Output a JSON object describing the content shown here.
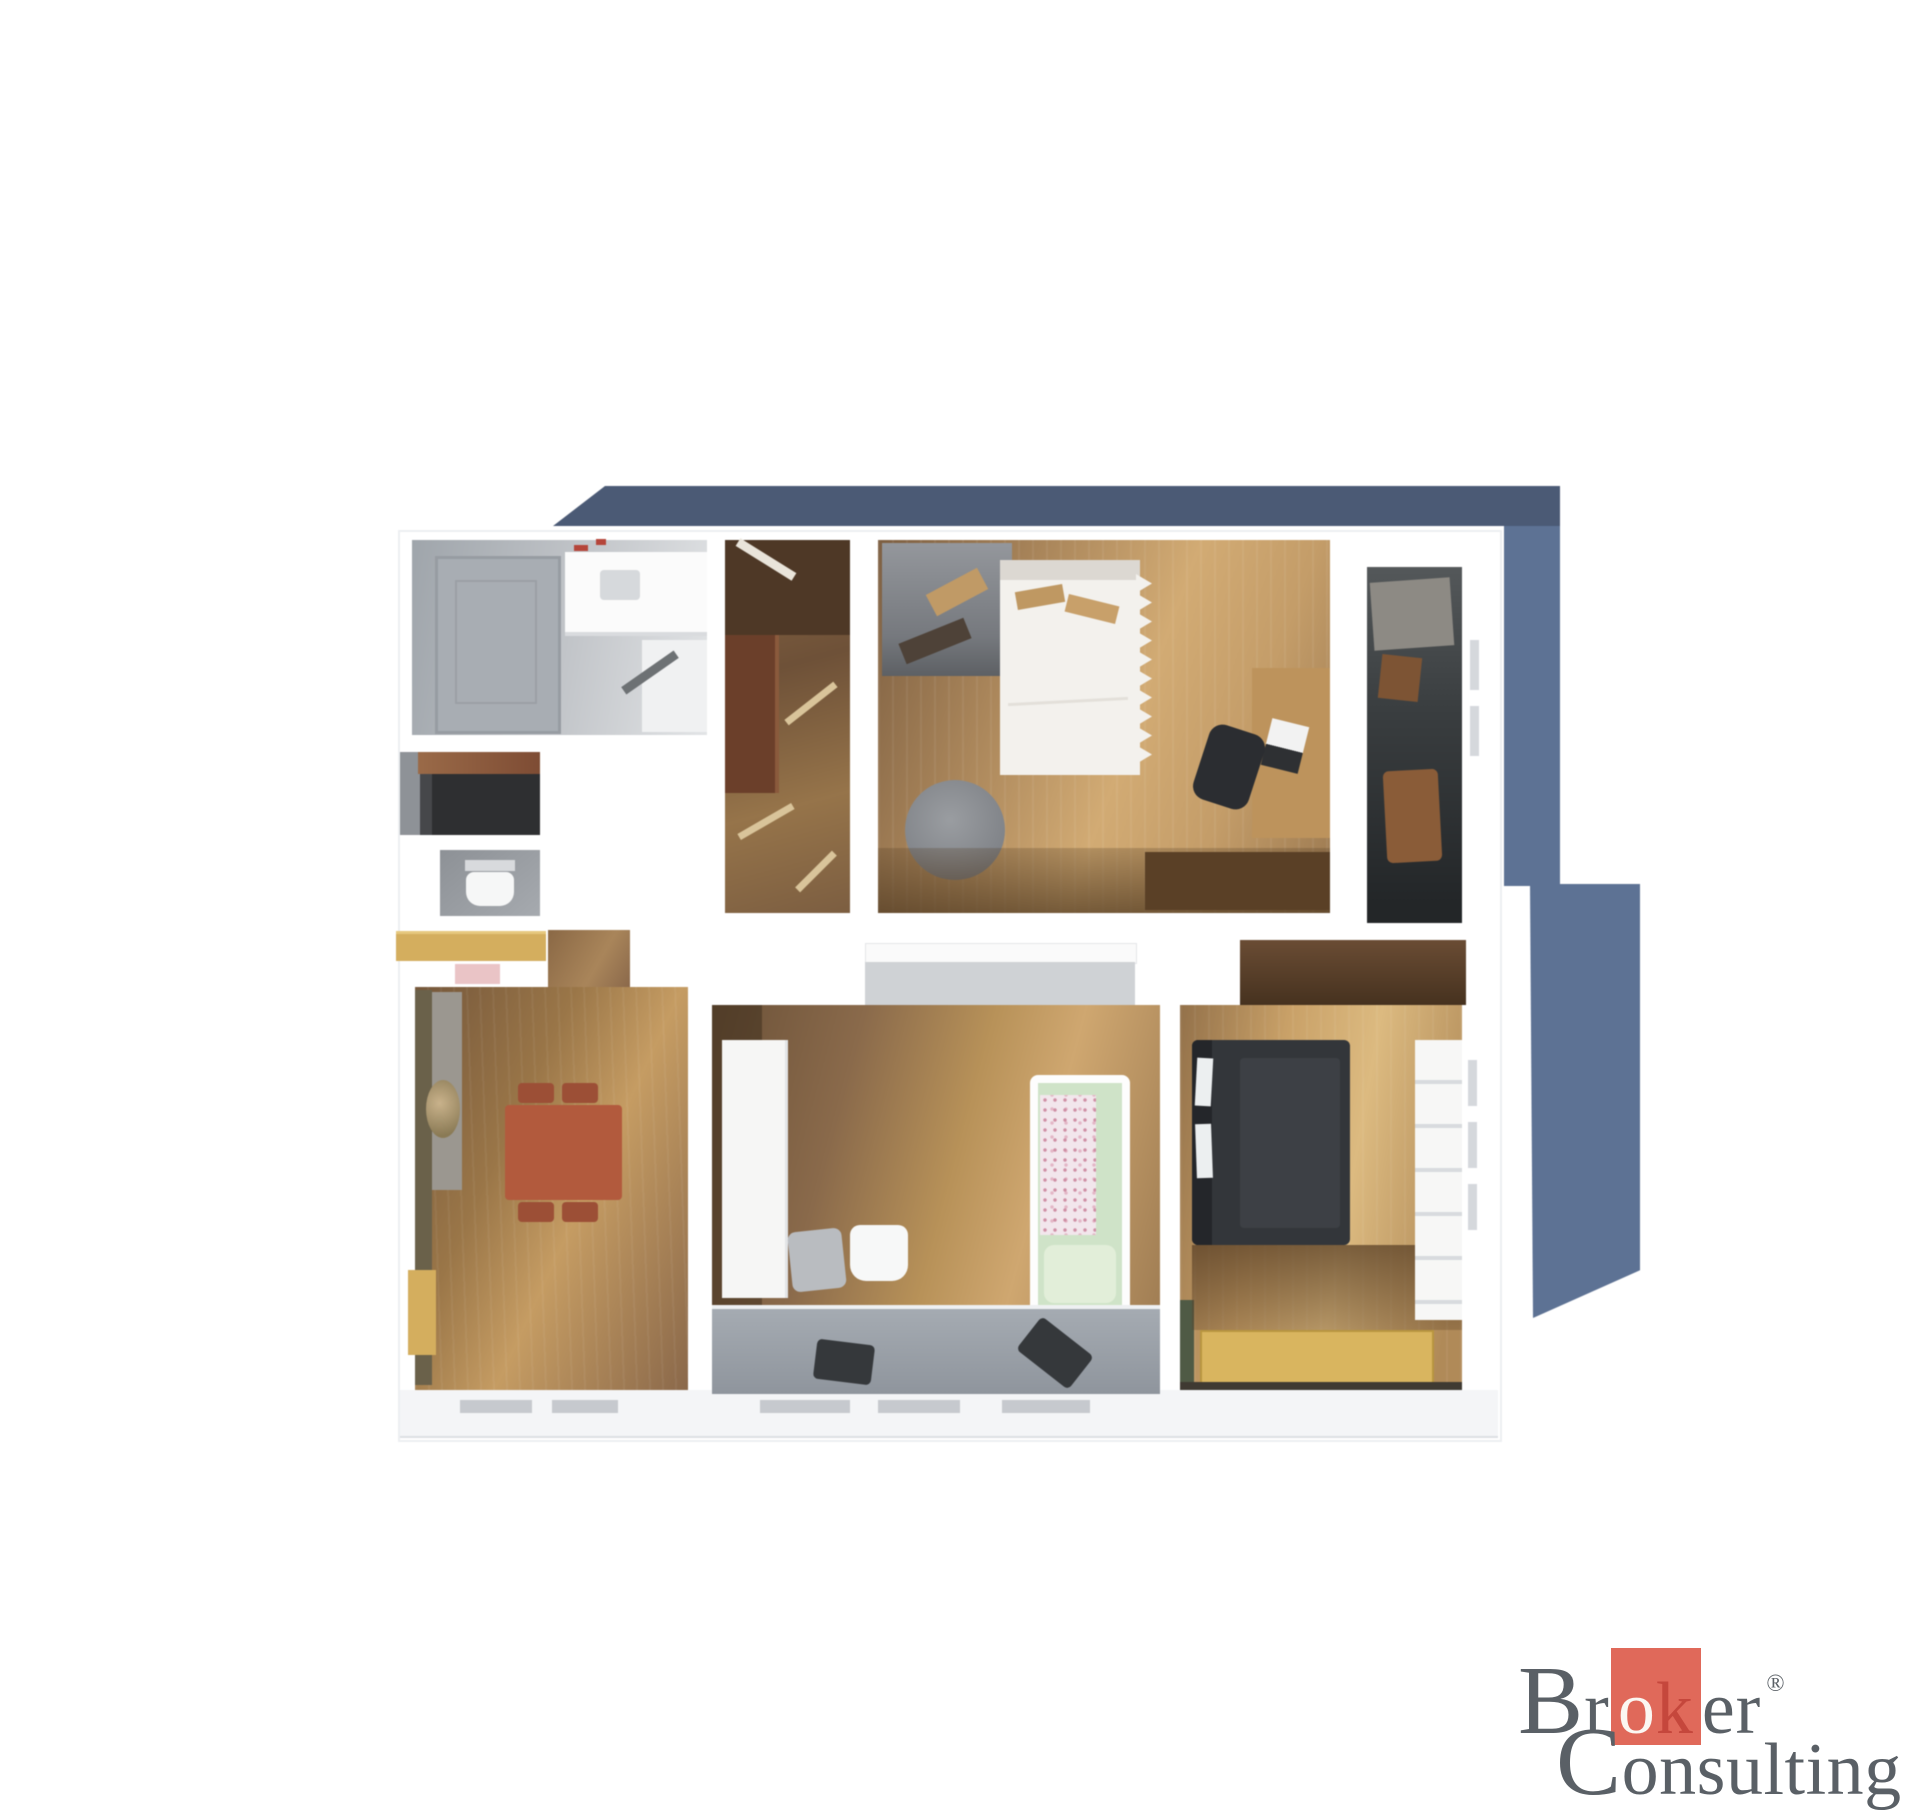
{
  "image_type": "3d-apartment-floorplan-render",
  "theme": {
    "page_bg": "#ffffff",
    "shadow_top": "#4b5a75",
    "shadow_side": "#5d7294",
    "wall": "#ffffff",
    "counter_yellow": "#d4ae5e",
    "pink_item": "#eac4c6",
    "utility_dark": "#2e2f31",
    "wardrobe_brown": "#6b3f2a",
    "bed_white": "#f3f1ed",
    "bed_dark": "#33363a",
    "table_red": "#b25a3d",
    "rug_yellow": "#d9b55f",
    "bathtub_mint": "#cfe3c8",
    "desk_wood": "#bd935c",
    "logo_text": "#5a6066",
    "logo_square": "#e0695a",
    "logo_o": "#fbf7f2",
    "logo_k": "#c5473c"
  },
  "floorplan": {
    "rooms": [
      {
        "name": "bathroom-top-left",
        "floor": "gray-tile"
      },
      {
        "name": "utility-room",
        "floor": "dark"
      },
      {
        "name": "wc",
        "floor": "gray-tile"
      },
      {
        "name": "hallway",
        "floor": "wood"
      },
      {
        "name": "bedroom-top",
        "floor": "wood"
      },
      {
        "name": "loggia",
        "floor": "dark"
      },
      {
        "name": "kitchen-dining-room",
        "floor": "wood"
      },
      {
        "name": "bathroom-bottom",
        "floor": "wood-and-gray"
      },
      {
        "name": "bedroom-bottom-right",
        "floor": "wood"
      }
    ]
  },
  "logo": {
    "line1_initial": "B",
    "line1_pre": "r",
    "highlight_o": "o",
    "highlight_k": "k",
    "line1_suffix": "er",
    "registered_mark": "®",
    "line2_initial": "C",
    "line2_rest": "onsulting"
  }
}
